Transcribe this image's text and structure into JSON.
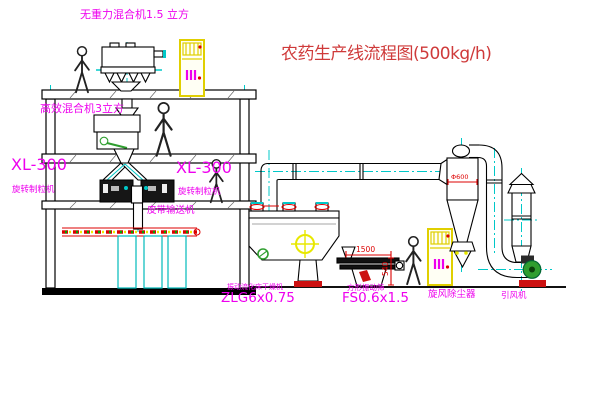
{
  "window": {
    "width": 600,
    "height": 403,
    "background": "#ffffff"
  },
  "title": {
    "text": "农药生产线流程图(500kg/h)"
  },
  "labels": {
    "top_mixer": "无重力混合机1.5 立方",
    "floor2_mixer": "高效混合机3立方",
    "granulator_left_model": "XL-300",
    "granulator_left_name": "旋转制粒机",
    "granulator_mid_model": "XL-300",
    "granulator_mid_name": "旋转制粒机",
    "belt_conveyor": "皮带输送机",
    "dryer_name": "振动流化床干燥机",
    "dryer_model": "ZLG6x0.75",
    "sieve_name": "方形振动筛",
    "sieve_model": "FS0.6x1.5",
    "cyclone": "旋风除尘器",
    "fan": "引风机"
  },
  "dimensions": {
    "sieve_length": "1500",
    "sieve_height": "540",
    "cyclone_diameter": "Φ600"
  },
  "colors": {
    "label_magenta": "#ee00ee",
    "title_red": "#cf3a3a",
    "centerline_cyan": "#00c8c8",
    "cabinet_yellow": "#e0cf00",
    "dimension_red": "#dd0000",
    "machine_green": "#2f9e2f",
    "crosshair_yellow": "#e8e800",
    "belt_red": "#dd0000"
  }
}
